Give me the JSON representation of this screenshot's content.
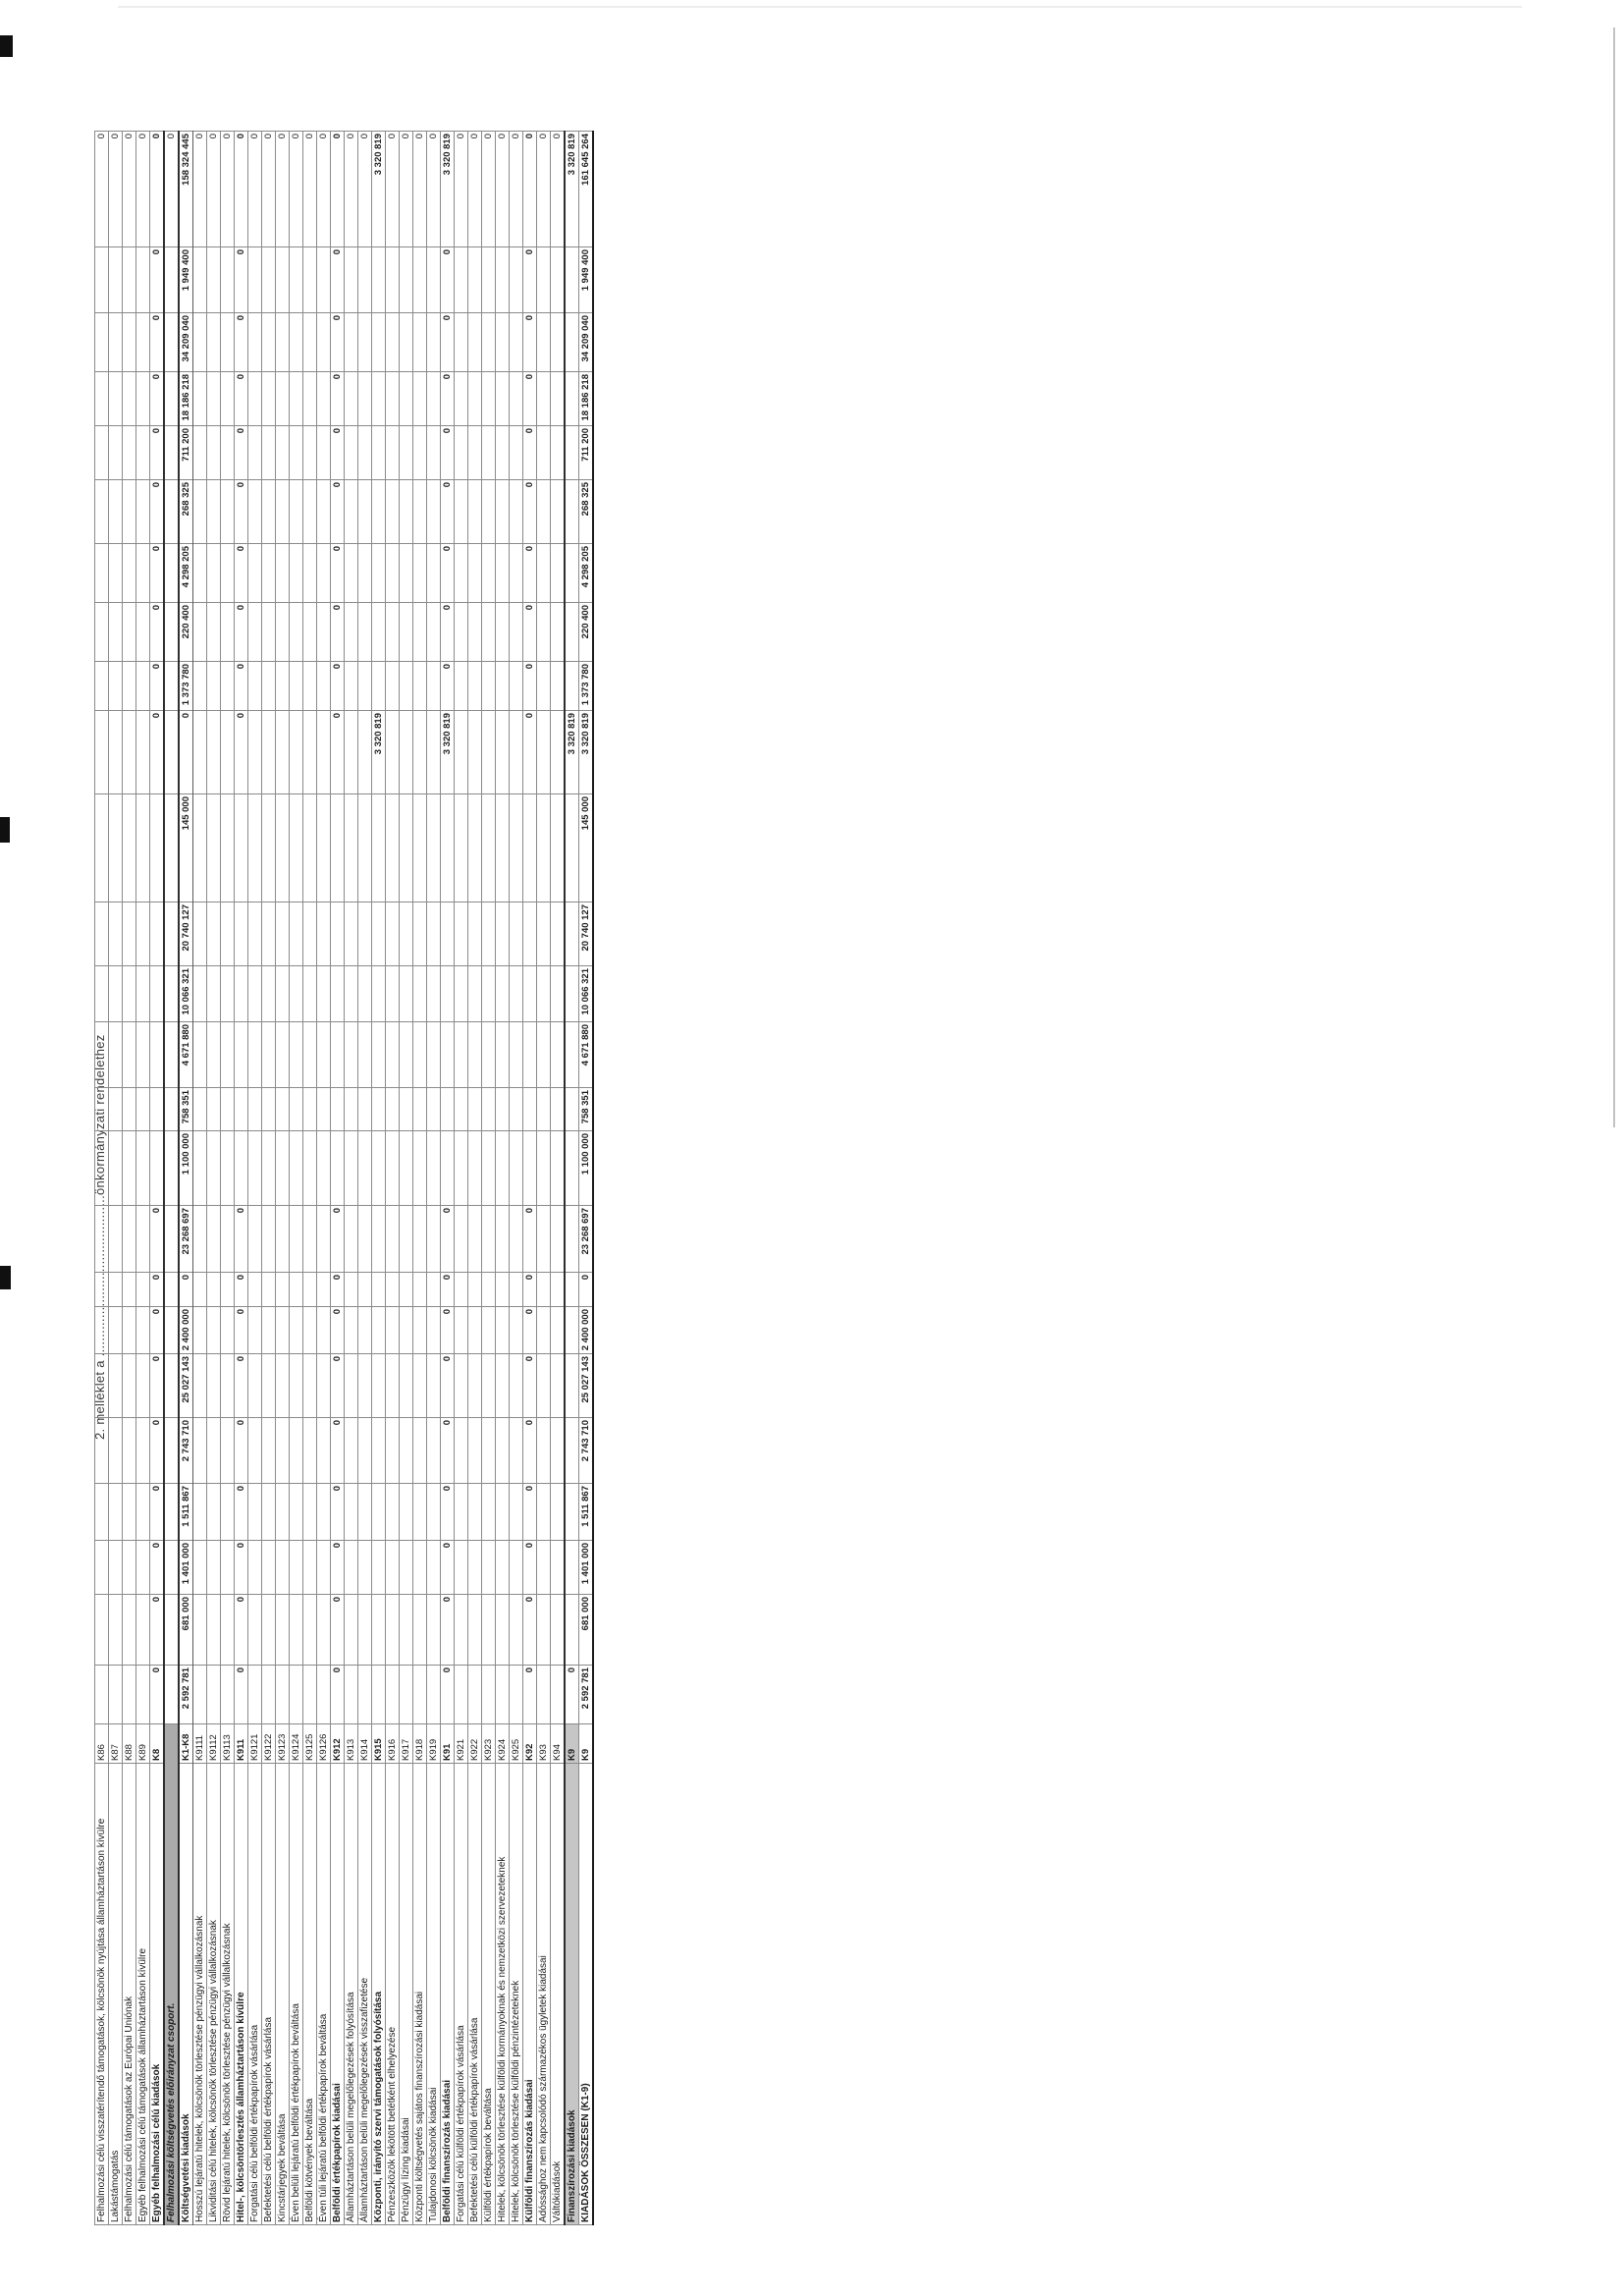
{
  "page": {
    "caption": "2. melléklet a ..........................................önkormányzati rendelethez"
  },
  "colors": {
    "ink": "#1c1c1c",
    "grid_line": "#8a8a8a",
    "group_row_shade": "#ababab",
    "k9_row_shade": "#c6c6c6",
    "paper": "#ffffff"
  },
  "table": {
    "orientation": "rotated-90-ccw",
    "rows": [
      {
        "code": "K86",
        "label": "Felhalmozási célú visszatérítendő támogatások, kölcsönök nyújtása államháztartáson kívülre",
        "style": "detail",
        "values": [
          "",
          "",
          "",
          "",
          "",
          "",
          "",
          "",
          "",
          "",
          "",
          "",
          "",
          "",
          "",
          "",
          "",
          "",
          "",
          "",
          "",
          "",
          "",
          ""
        ],
        "total": "0"
      },
      {
        "code": "K87",
        "label": "Lakástámogatás",
        "style": "detail",
        "values": [
          "",
          "",
          "",
          "",
          "",
          "",
          "",
          "",
          "",
          "",
          "",
          "",
          "",
          "",
          "",
          "",
          "",
          "",
          "",
          "",
          "",
          "",
          "",
          ""
        ],
        "total": "0"
      },
      {
        "code": "K88",
        "label": "Felhalmozási célú támogatások az Európai Uniónak",
        "style": "detail",
        "values": [
          "",
          "",
          "",
          "",
          "",
          "",
          "",
          "",
          "",
          "",
          "",
          "",
          "",
          "",
          "",
          "",
          "",
          "",
          "",
          "",
          "",
          "",
          "",
          ""
        ],
        "total": "0"
      },
      {
        "code": "K89",
        "label": "Egyéb felhalmozási célú támogatások államháztartáson kívülre",
        "style": "detail",
        "values": [
          "",
          "",
          "",
          "",
          "",
          "",
          "",
          "",
          "",
          "",
          "",
          "",
          "",
          "",
          "",
          "",
          "",
          "",
          "",
          "",
          "",
          "",
          "",
          ""
        ],
        "total": "0"
      },
      {
        "code": "K8",
        "label": "Egyéb felhalmozási célú kiadások",
        "style": "bold",
        "values": [
          "0",
          "0",
          "0",
          "0",
          "0",
          "0",
          "0",
          "0",
          "0",
          "",
          "",
          "",
          "",
          "",
          "",
          "0",
          "0",
          "0",
          "0",
          "0",
          "0",
          "0",
          "0",
          "0"
        ],
        "total": "0"
      },
      {
        "code": "",
        "label": "Felhalmozási költségvetés előirányzat csoport.",
        "style": "group",
        "values": [
          "",
          "",
          "",
          "",
          "",
          "",
          "",
          "",
          "",
          "",
          "",
          "",
          "",
          "",
          "",
          "",
          "",
          "",
          "",
          "",
          "",
          "",
          "",
          ""
        ],
        "total": "0"
      },
      {
        "code": "K1-K8",
        "label": "Költségvetési kiadások",
        "style": "k1k8",
        "values": [
          "2 592 781",
          "681 000",
          "1 401 000",
          "1 511 867",
          "2 743 710",
          "25 027 143",
          "2 400 000",
          "0",
          "23 268 697",
          "1 100 000",
          "758 351",
          "4 671 880",
          "10 066 321",
          "20 740 127",
          "145 000",
          "0",
          "1 373 780",
          "220 400",
          "4 298 205",
          "268 325",
          "711 200",
          "18 186 218",
          "34 209 040",
          "1 949 400"
        ],
        "total": "158 324 445"
      },
      {
        "code": "K9111",
        "label": "Hosszú lejáratú hitelek, kölcsönök törlesztése pénzügyi vállalkozásnak",
        "style": "detail",
        "values": [
          "",
          "",
          "",
          "",
          "",
          "",
          "",
          "",
          "",
          "",
          "",
          "",
          "",
          "",
          "",
          "",
          "",
          "",
          "",
          "",
          "",
          "",
          "",
          ""
        ],
        "total": "0"
      },
      {
        "code": "K9112",
        "label": "Likviditási célú hitelek, kölcsönök törlesztése pénzügyi vállalkozásnak",
        "style": "detail",
        "values": [
          "",
          "",
          "",
          "",
          "",
          "",
          "",
          "",
          "",
          "",
          "",
          "",
          "",
          "",
          "",
          "",
          "",
          "",
          "",
          "",
          "",
          "",
          "",
          ""
        ],
        "total": "0"
      },
      {
        "code": "K9113",
        "label": "Rövid lejáratú hitelek, kölcsönök törlesztése pénzügyi vállalkozásnak",
        "style": "detail",
        "values": [
          "",
          "",
          "",
          "",
          "",
          "",
          "",
          "",
          "",
          "",
          "",
          "",
          "",
          "",
          "",
          "",
          "",
          "",
          "",
          "",
          "",
          "",
          "",
          ""
        ],
        "total": "0"
      },
      {
        "code": "K911",
        "label": "Hitel-, kölcsöntörlesztés államháztartáson kívülre",
        "style": "bold",
        "values": [
          "0",
          "0",
          "0",
          "0",
          "0",
          "0",
          "0",
          "0",
          "0",
          "",
          "",
          "",
          "",
          "",
          "",
          "0",
          "0",
          "0",
          "0",
          "0",
          "0",
          "0",
          "0",
          "0"
        ],
        "total": "0"
      },
      {
        "code": "K9121",
        "label": "Forgatási célú belföldi értékpapírok vásárlása",
        "style": "detail",
        "values": [
          "",
          "",
          "",
          "",
          "",
          "",
          "",
          "",
          "",
          "",
          "",
          "",
          "",
          "",
          "",
          "",
          "",
          "",
          "",
          "",
          "",
          "",
          "",
          ""
        ],
        "total": "0"
      },
      {
        "code": "K9122",
        "label": "Befektetési célú belföldi értékpapírok vásárlása",
        "style": "detail",
        "values": [
          "",
          "",
          "",
          "",
          "",
          "",
          "",
          "",
          "",
          "",
          "",
          "",
          "",
          "",
          "",
          "",
          "",
          "",
          "",
          "",
          "",
          "",
          "",
          ""
        ],
        "total": "0"
      },
      {
        "code": "K9123",
        "label": "Kincstárjegyek beváltása",
        "style": "detail",
        "values": [
          "",
          "",
          "",
          "",
          "",
          "",
          "",
          "",
          "",
          "",
          "",
          "",
          "",
          "",
          "",
          "",
          "",
          "",
          "",
          "",
          "",
          "",
          "",
          ""
        ],
        "total": "0"
      },
      {
        "code": "K9124",
        "label": "Éven belüli lejáratú belföldi értékpapírok beváltása",
        "style": "detail",
        "values": [
          "",
          "",
          "",
          "",
          "",
          "",
          "",
          "",
          "",
          "",
          "",
          "",
          "",
          "",
          "",
          "",
          "",
          "",
          "",
          "",
          "",
          "",
          "",
          ""
        ],
        "total": "0"
      },
      {
        "code": "K9125",
        "label": "Belföldi kötvények beváltása",
        "style": "detail",
        "values": [
          "",
          "",
          "",
          "",
          "",
          "",
          "",
          "",
          "",
          "",
          "",
          "",
          "",
          "",
          "",
          "",
          "",
          "",
          "",
          "",
          "",
          "",
          "",
          ""
        ],
        "total": "0"
      },
      {
        "code": "K9126",
        "label": "Éven túli lejáratú belföldi értékpapírok beváltása",
        "style": "detail",
        "values": [
          "",
          "",
          "",
          "",
          "",
          "",
          "",
          "",
          "",
          "",
          "",
          "",
          "",
          "",
          "",
          "",
          "",
          "",
          "",
          "",
          "",
          "",
          "",
          ""
        ],
        "total": "0"
      },
      {
        "code": "K912",
        "label": "Belföldi értékpapírok kiadásai",
        "style": "bold",
        "values": [
          "0",
          "0",
          "0",
          "0",
          "0",
          "0",
          "0",
          "0",
          "0",
          "",
          "",
          "",
          "",
          "",
          "",
          "0",
          "0",
          "0",
          "0",
          "0",
          "0",
          "0",
          "0",
          "0"
        ],
        "total": "0"
      },
      {
        "code": "K913",
        "label": "Államháztartáson belüli megelőlegezések folyósítása",
        "style": "detail",
        "values": [
          "",
          "",
          "",
          "",
          "",
          "",
          "",
          "",
          "",
          "",
          "",
          "",
          "",
          "",
          "",
          "",
          "",
          "",
          "",
          "",
          "",
          "",
          "",
          ""
        ],
        "total": "0"
      },
      {
        "code": "K914",
        "label": "Államháztartáson belüli megelőlegezések visszafizetése",
        "style": "detail",
        "values": [
          "",
          "",
          "",
          "",
          "",
          "",
          "",
          "",
          "",
          "",
          "",
          "",
          "",
          "",
          "",
          "",
          "",
          "",
          "",
          "",
          "",
          "",
          "",
          ""
        ],
        "total": "0"
      },
      {
        "code": "K915",
        "label": "Központi, irányító szervi támogatások folyósítása",
        "style": "bold",
        "values": [
          "",
          "",
          "",
          "",
          "",
          "",
          "",
          "",
          "",
          "",
          "",
          "",
          "",
          "",
          "",
          "3 320 819",
          "",
          "",
          "",
          "",
          "",
          "",
          "",
          ""
        ],
        "total": "3 320 819"
      },
      {
        "code": "K916",
        "label": "Pénzeszközök lekötött betétként elhelyezése",
        "style": "detail",
        "values": [
          "",
          "",
          "",
          "",
          "",
          "",
          "",
          "",
          "",
          "",
          "",
          "",
          "",
          "",
          "",
          "",
          "",
          "",
          "",
          "",
          "",
          "",
          "",
          ""
        ],
        "total": "0"
      },
      {
        "code": "K917",
        "label": "Pénzügyi lízing kiadásai",
        "style": "detail",
        "values": [
          "",
          "",
          "",
          "",
          "",
          "",
          "",
          "",
          "",
          "",
          "",
          "",
          "",
          "",
          "",
          "",
          "",
          "",
          "",
          "",
          "",
          "",
          "",
          ""
        ],
        "total": "0"
      },
      {
        "code": "K918",
        "label": "Központi költségvetés sajátos finanszírozási kiadásai",
        "style": "detail",
        "values": [
          "",
          "",
          "",
          "",
          "",
          "",
          "",
          "",
          "",
          "",
          "",
          "",
          "",
          "",
          "",
          "",
          "",
          "",
          "",
          "",
          "",
          "",
          "",
          ""
        ],
        "total": "0"
      },
      {
        "code": "K919",
        "label": "Tulajdonosi kölcsönök kiadásai",
        "style": "detail",
        "values": [
          "",
          "",
          "",
          "",
          "",
          "",
          "",
          "",
          "",
          "",
          "",
          "",
          "",
          "",
          "",
          "",
          "",
          "",
          "",
          "",
          "",
          "",
          "",
          ""
        ],
        "total": "0"
      },
      {
        "code": "K91",
        "label": "Belföldi finanszírozás kiadásai",
        "style": "bold",
        "values": [
          "0",
          "0",
          "0",
          "0",
          "0",
          "0",
          "0",
          "0",
          "0",
          "",
          "",
          "",
          "",
          "",
          "",
          "3 320 819",
          "0",
          "0",
          "0",
          "0",
          "0",
          "0",
          "0",
          "0"
        ],
        "total": "3 320 819"
      },
      {
        "code": "K921",
        "label": "Forgatási célú külföldi értékpapírok vásárlása",
        "style": "detail",
        "values": [
          "",
          "",
          "",
          "",
          "",
          "",
          "",
          "",
          "",
          "",
          "",
          "",
          "",
          "",
          "",
          "",
          "",
          "",
          "",
          "",
          "",
          "",
          "",
          ""
        ],
        "total": "0"
      },
      {
        "code": "K922",
        "label": "Befektetési célú külföldi értékpapírok vásárlása",
        "style": "detail",
        "values": [
          "",
          "",
          "",
          "",
          "",
          "",
          "",
          "",
          "",
          "",
          "",
          "",
          "",
          "",
          "",
          "",
          "",
          "",
          "",
          "",
          "",
          "",
          "",
          ""
        ],
        "total": "0"
      },
      {
        "code": "K923",
        "label": "Külföldi értékpapírok beváltása",
        "style": "detail",
        "values": [
          "",
          "",
          "",
          "",
          "",
          "",
          "",
          "",
          "",
          "",
          "",
          "",
          "",
          "",
          "",
          "",
          "",
          "",
          "",
          "",
          "",
          "",
          "",
          ""
        ],
        "total": "0"
      },
      {
        "code": "K924",
        "label": "Hitelek, kölcsönök törlesztése külföldi kormányoknak és nemzetközi szervezeteknek",
        "style": "detail",
        "values": [
          "",
          "",
          "",
          "",
          "",
          "",
          "",
          "",
          "",
          "",
          "",
          "",
          "",
          "",
          "",
          "",
          "",
          "",
          "",
          "",
          "",
          "",
          "",
          ""
        ],
        "total": "0"
      },
      {
        "code": "K925",
        "label": "Hitelek, kölcsönök törlesztése külföldi pénzintézeteknek",
        "style": "detail",
        "values": [
          "",
          "",
          "",
          "",
          "",
          "",
          "",
          "",
          "",
          "",
          "",
          "",
          "",
          "",
          "",
          "",
          "",
          "",
          "",
          "",
          "",
          "",
          "",
          ""
        ],
        "total": "0"
      },
      {
        "code": "K92",
        "label": "Külföldi finanszírozás kiadásai",
        "style": "bold",
        "values": [
          "0",
          "0",
          "0",
          "0",
          "0",
          "0",
          "0",
          "0",
          "0",
          "",
          "",
          "",
          "",
          "",
          "",
          "0",
          "0",
          "0",
          "0",
          "0",
          "0",
          "0",
          "0",
          "0"
        ],
        "total": "0"
      },
      {
        "code": "K93",
        "label": "Adóssághoz nem kapcsolódó származékos ügyletek kiadásai",
        "style": "detail",
        "values": [
          "",
          "",
          "",
          "",
          "",
          "",
          "",
          "",
          "",
          "",
          "",
          "",
          "",
          "",
          "",
          "",
          "",
          "",
          "",
          "",
          "",
          "",
          "",
          ""
        ],
        "total": "0"
      },
      {
        "code": "K94",
        "label": "Váltókiadások",
        "style": "detail",
        "values": [
          "",
          "",
          "",
          "",
          "",
          "",
          "",
          "",
          "",
          "",
          "",
          "",
          "",
          "",
          "",
          "",
          "",
          "",
          "",
          "",
          "",
          "",
          "",
          ""
        ],
        "total": "0"
      },
      {
        "code": "K9",
        "label": "Finanszírozási kiadások",
        "style": "k9",
        "values": [
          "0",
          "",
          "",
          "",
          "",
          "",
          "",
          "",
          "",
          "",
          "",
          "",
          "",
          "",
          "",
          "3 320 819",
          "",
          "",
          "",
          "",
          "",
          "",
          "",
          ""
        ],
        "total": "3 320 819"
      },
      {
        "code": "K9",
        "label": "KIADÁSOK ÖSSZESEN (K1-9)",
        "style": "total",
        "values": [
          "2 592 781",
          "681 000",
          "1 401 000",
          "1 511 867",
          "2 743 710",
          "25 027 143",
          "2 400 000",
          "0",
          "23 268 697",
          "1 100 000",
          "758 351",
          "4 671 880",
          "10 066 321",
          "20 740 127",
          "145 000",
          "3 320 819",
          "1 373 780",
          "220 400",
          "4 298 205",
          "268 325",
          "711 200",
          "18 186 218",
          "34 209 040",
          "1 949 400"
        ],
        "total": "161 645 264"
      }
    ]
  }
}
